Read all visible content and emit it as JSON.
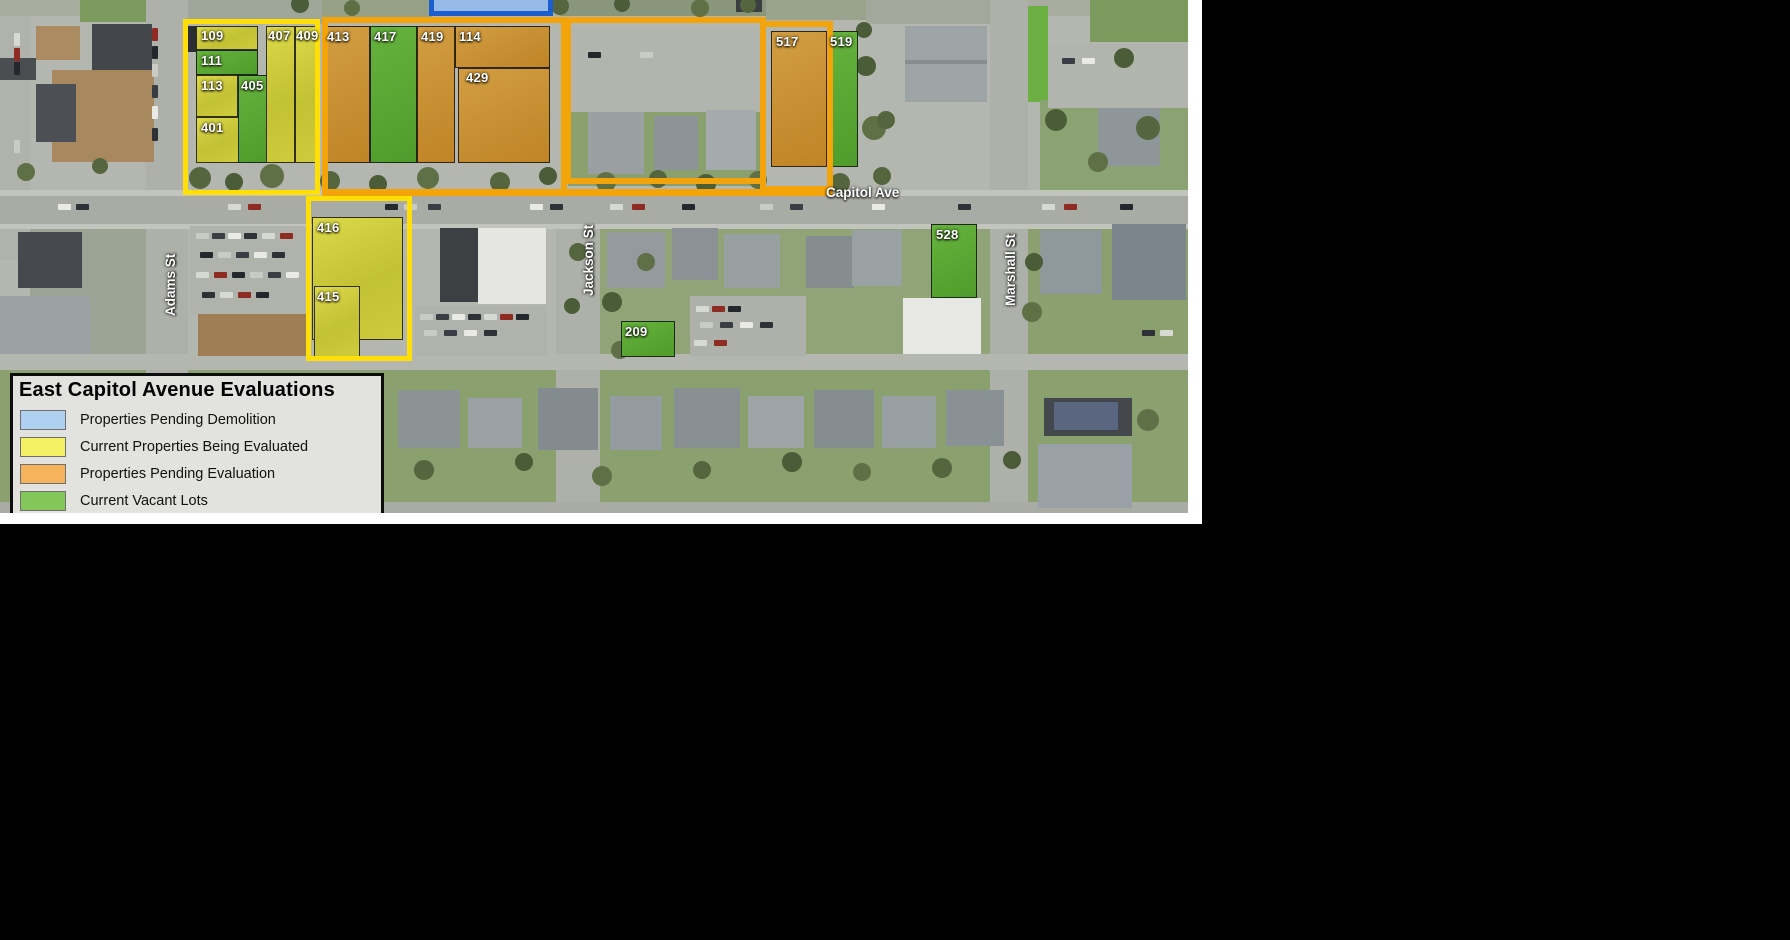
{
  "map_title": "East Capitol Avenue Evaluations",
  "legend": {
    "title": "East Capitol Avenue Evaluations",
    "items": [
      {
        "label": "Properties Pending Demolition",
        "color": "#aed1f2"
      },
      {
        "label": "Current Properties Being Evaluated",
        "color": "#f3f163"
      },
      {
        "label": "Properties Pending Evaluation",
        "color": "#f5b45c"
      },
      {
        "label": "Current Vacant Lots",
        "color": "#83c659"
      }
    ]
  },
  "streets": [
    {
      "name": "Capitol Ave",
      "x": 826,
      "y": 186,
      "vertical": false
    },
    {
      "name": "Adams St",
      "x": 164,
      "y": 316,
      "vertical": true
    },
    {
      "name": "Jackson St",
      "x": 582,
      "y": 296,
      "vertical": true
    },
    {
      "name": "Marshall St",
      "x": 1004,
      "y": 306,
      "vertical": true
    }
  ],
  "status_colors": {
    "pending_demolition_fill": "#95bae8",
    "pending_demolition_outline": "#1c5ed0",
    "being_evaluated_outline": "#ffdf06",
    "pending_evaluation_outline": "#f3a40a",
    "vacant_lot_fill": "#58a933"
  },
  "overlays": {
    "clusters": [
      {
        "name": "pending-demolition",
        "color": "#1c5ed0",
        "x": 429,
        "y": -6,
        "w": 124,
        "h": 22,
        "stroke": 5,
        "fill": "#95bae8"
      },
      {
        "name": "being-evaluated-north",
        "color": "#ffdf06",
        "x": 183,
        "y": 19,
        "w": 137,
        "h": 176,
        "stroke": 5
      },
      {
        "name": "being-evaluated-south",
        "color": "#ffdf06",
        "x": 306,
        "y": 196,
        "w": 106,
        "h": 165,
        "stroke": 5
      },
      {
        "name": "pending-evaluation-west",
        "color": "#f3a40a",
        "x": 322,
        "y": 17,
        "w": 245,
        "h": 178,
        "stroke": 6
      },
      {
        "name": "pending-evaluation-mid",
        "color": "#f3a40a",
        "x": 565,
        "y": 17,
        "w": 201,
        "h": 167,
        "stroke": 6
      },
      {
        "name": "pending-evaluation-517",
        "color": "#f3a40a",
        "x": 760,
        "y": 21,
        "w": 73,
        "h": 171,
        "stroke": 6
      }
    ],
    "bars": [
      {
        "name": "capitol-ave-line",
        "x": 322,
        "y": 189,
        "w": 511,
        "h": 7,
        "color": "#f3a40a"
      }
    ]
  },
  "parcels": [
    {
      "id": "109",
      "type": "yellow",
      "x": 196,
      "y": 26,
      "w": 62,
      "h": 24,
      "lx": 201,
      "ly": 29
    },
    {
      "id": "111",
      "type": "green",
      "x": 196,
      "y": 50,
      "w": 62,
      "h": 25,
      "lx": 201,
      "ly": 54
    },
    {
      "id": "113",
      "type": "yellow",
      "x": 196,
      "y": 75,
      "w": 42,
      "h": 42,
      "lx": 201,
      "ly": 79
    },
    {
      "id": "401",
      "type": "yellow",
      "x": 196,
      "y": 117,
      "w": 44,
      "h": 46,
      "lx": 201,
      "ly": 121
    },
    {
      "id": "405",
      "type": "green",
      "x": 238,
      "y": 75,
      "w": 30,
      "h": 88,
      "lx": 241,
      "ly": 79
    },
    {
      "id": "407",
      "type": "yellow",
      "x": 266,
      "y": 26,
      "w": 29,
      "h": 137,
      "lx": 268,
      "ly": 29
    },
    {
      "id": "409",
      "type": "yellow",
      "x": 295,
      "y": 26,
      "w": 23,
      "h": 137,
      "lx": 296,
      "ly": 29
    },
    {
      "id": "413",
      "type": "orange",
      "x": 322,
      "y": 26,
      "w": 48,
      "h": 137,
      "lx": 327,
      "ly": 30
    },
    {
      "id": "417",
      "type": "green",
      "x": 370,
      "y": 26,
      "w": 47,
      "h": 137,
      "lx": 374,
      "ly": 30
    },
    {
      "id": "419",
      "type": "orange",
      "x": 417,
      "y": 26,
      "w": 38,
      "h": 137,
      "lx": 421,
      "ly": 30
    },
    {
      "id": "114",
      "type": "orange",
      "x": 455,
      "y": 26,
      "w": 95,
      "h": 42,
      "lx": 459,
      "ly": 30
    },
    {
      "id": "429",
      "type": "orange",
      "x": 458,
      "y": 68,
      "w": 92,
      "h": 95,
      "lx": 466,
      "ly": 71
    },
    {
      "id": "517",
      "type": "orange",
      "x": 771,
      "y": 31,
      "w": 56,
      "h": 136,
      "lx": 776,
      "ly": 35
    },
    {
      "id": "519",
      "type": "green",
      "x": 827,
      "y": 31,
      "w": 31,
      "h": 136,
      "lx": 830,
      "ly": 35
    },
    {
      "id": "416",
      "type": "yellow",
      "x": 312,
      "y": 217,
      "w": 91,
      "h": 123,
      "lx": 317,
      "ly": 221
    },
    {
      "id": "415",
      "type": "yellow",
      "x": 314,
      "y": 286,
      "w": 46,
      "h": 71,
      "lx": 317,
      "ly": 290
    },
    {
      "id": "209",
      "type": "green",
      "x": 621,
      "y": 321,
      "w": 54,
      "h": 36,
      "lx": 625,
      "ly": 325
    },
    {
      "id": "528",
      "type": "green",
      "x": 931,
      "y": 224,
      "w": 46,
      "h": 74,
      "lx": 936,
      "ly": 228
    }
  ],
  "frame": {
    "color": "#ffffff",
    "right": {
      "x": 1188,
      "y": 0,
      "w": 14,
      "h": 524
    },
    "bottom": {
      "x": 0,
      "y": 513,
      "w": 1202,
      "h": 11
    }
  },
  "scenery": {
    "rects": [
      [
        0,
        0,
        1188,
        16,
        "#a8ad9f"
      ],
      [
        80,
        0,
        70,
        22,
        "#7d9a5e"
      ],
      [
        155,
        0,
        170,
        24,
        "#9fa79a"
      ],
      [
        322,
        0,
        110,
        18,
        "#96a186"
      ],
      [
        560,
        0,
        206,
        16,
        "#8a967c"
      ],
      [
        766,
        0,
        100,
        20,
        "#9aa38e"
      ],
      [
        866,
        0,
        130,
        24,
        "#a2a89c"
      ],
      [
        1090,
        0,
        98,
        42,
        "#7d9a5e"
      ],
      [
        1018,
        6,
        30,
        96,
        "#6cb044"
      ],
      [
        0,
        370,
        1188,
        143,
        "#8ba06f"
      ],
      [
        600,
        229,
        390,
        126,
        "#90a478"
      ],
      [
        1028,
        229,
        160,
        126,
        "#8ba06f"
      ],
      [
        30,
        229,
        116,
        126,
        "#9ba394"
      ],
      [
        568,
        112,
        196,
        74,
        "#8ba06f"
      ],
      [
        1040,
        100,
        148,
        100,
        "#8ba272"
      ],
      [
        0,
        16,
        30,
        244,
        "#b0b3ab"
      ],
      [
        146,
        0,
        42,
        513,
        "#aeb1a9"
      ],
      [
        990,
        0,
        38,
        513,
        "#aeb1a9"
      ],
      [
        556,
        220,
        44,
        293,
        "#aeb1a9"
      ],
      [
        0,
        196,
        1188,
        28,
        "#a9aca4"
      ],
      [
        0,
        354,
        1188,
        16,
        "#b4b6b0"
      ],
      [
        0,
        502,
        1188,
        11,
        "#a9aca4"
      ],
      [
        0,
        190,
        1188,
        6,
        "#c2c4be"
      ],
      [
        0,
        224,
        1188,
        5,
        "#c2c4be"
      ],
      [
        570,
        28,
        192,
        84,
        "#b2b5ad"
      ],
      [
        1048,
        44,
        140,
        64,
        "#b2b5ad"
      ],
      [
        190,
        226,
        118,
        88,
        "#b0b3ab"
      ],
      [
        415,
        306,
        132,
        50,
        "#b0b3ab"
      ],
      [
        690,
        296,
        116,
        60,
        "#aeb1a9"
      ],
      [
        0,
        58,
        36,
        22,
        "#4a4e50"
      ],
      [
        36,
        26,
        44,
        34,
        "#ab8c62"
      ],
      [
        92,
        24,
        60,
        46,
        "#43474b"
      ],
      [
        52,
        70,
        102,
        92,
        "#a8895f"
      ],
      [
        36,
        84,
        40,
        58,
        "#4c5054"
      ],
      [
        905,
        26,
        82,
        76,
        "#9da4a6"
      ],
      [
        905,
        60,
        82,
        4,
        "#878e90"
      ],
      [
        588,
        112,
        56,
        62,
        "#9aa0a2"
      ],
      [
        654,
        116,
        44,
        54,
        "#8d9396"
      ],
      [
        706,
        110,
        50,
        60,
        "#a5abad"
      ],
      [
        1098,
        108,
        62,
        58,
        "#8f9699"
      ],
      [
        18,
        232,
        64,
        56,
        "#464a4e"
      ],
      [
        0,
        296,
        90,
        58,
        "#9ba1a3"
      ],
      [
        198,
        314,
        110,
        42,
        "#9e7f55"
      ],
      [
        440,
        228,
        38,
        74,
        "#3c4043"
      ],
      [
        478,
        228,
        68,
        76,
        "#e5e5e1"
      ],
      [
        607,
        232,
        58,
        56,
        "#949a9d"
      ],
      [
        672,
        228,
        46,
        52,
        "#8b9194"
      ],
      [
        724,
        234,
        56,
        54,
        "#99a0a2"
      ],
      [
        806,
        236,
        48,
        52,
        "#868d8f"
      ],
      [
        852,
        230,
        50,
        56,
        "#9aa1a3"
      ],
      [
        903,
        298,
        78,
        56,
        "#e7e7e3"
      ],
      [
        1040,
        230,
        62,
        64,
        "#8f989a"
      ],
      [
        1112,
        224,
        74,
        76,
        "#7b858b"
      ],
      [
        398,
        390,
        62,
        58,
        "#8c9395"
      ],
      [
        468,
        398,
        54,
        50,
        "#9aa0a3"
      ],
      [
        538,
        388,
        60,
        62,
        "#848b8e"
      ],
      [
        610,
        396,
        52,
        54,
        "#959c9f"
      ],
      [
        674,
        388,
        66,
        60,
        "#899093"
      ],
      [
        748,
        396,
        56,
        52,
        "#9ea4a7"
      ],
      [
        814,
        390,
        60,
        58,
        "#868d90"
      ],
      [
        882,
        396,
        54,
        52,
        "#99a0a3"
      ],
      [
        946,
        390,
        58,
        56,
        "#8a9194"
      ],
      [
        1044,
        398,
        88,
        38,
        "#44484c"
      ],
      [
        1054,
        402,
        64,
        28,
        "#5a6680"
      ],
      [
        1038,
        444,
        94,
        64,
        "#99a1a7"
      ],
      [
        184,
        26,
        12,
        26,
        "#2b2e30"
      ],
      [
        736,
        0,
        26,
        12,
        "#3a3e40"
      ]
    ],
    "car_palette": [
      "#e9e9e5",
      "#2e3237",
      "#d7d9d3",
      "#8e2b22",
      "#24282c",
      "#c9cbc5",
      "#3a3e44"
    ],
    "car_rows": [
      {
        "y": 204,
        "xs": [
          58,
          76,
          228,
          248,
          385,
          404,
          428,
          530,
          550,
          610,
          632,
          682,
          760,
          790,
          872,
          958,
          1042,
          1064,
          1120
        ]
      },
      {
        "y": 233,
        "xs": [
          196,
          212,
          228,
          244,
          262,
          280
        ]
      },
      {
        "y": 252,
        "xs": [
          200,
          218,
          236,
          254,
          272
        ]
      },
      {
        "y": 272,
        "xs": [
          196,
          214,
          232,
          250,
          268,
          286
        ]
      },
      {
        "y": 292,
        "xs": [
          202,
          220,
          238,
          256
        ]
      },
      {
        "y": 314,
        "xs": [
          420,
          436,
          452,
          468,
          484,
          500,
          516
        ]
      },
      {
        "y": 330,
        "xs": [
          424,
          444,
          464,
          484
        ]
      },
      {
        "y": 306,
        "xs": [
          696,
          712,
          728
        ]
      },
      {
        "y": 322,
        "xs": [
          700,
          720,
          740,
          760
        ]
      },
      {
        "y": 340,
        "xs": [
          694,
          714
        ]
      },
      {
        "y": 52,
        "xs": [
          588,
          640
        ]
      },
      {
        "y": 58,
        "xs": [
          1062,
          1082
        ]
      },
      {
        "y": 330,
        "xs": [
          1142,
          1160
        ]
      }
    ],
    "car_cols": [
      {
        "x": 152,
        "ys": [
          28,
          46,
          64,
          85,
          106,
          128
        ]
      },
      {
        "x": 14,
        "ys": [
          33,
          48,
          62,
          140
        ]
      }
    ],
    "tree_palette": [
      "#55663f",
      "#4b5c38",
      "#5f7046"
    ],
    "trees": [
      [
        200,
        178,
        11
      ],
      [
        234,
        182,
        9
      ],
      [
        272,
        176,
        12
      ],
      [
        330,
        181,
        10
      ],
      [
        378,
        184,
        9
      ],
      [
        428,
        178,
        11
      ],
      [
        500,
        182,
        10
      ],
      [
        548,
        176,
        9
      ],
      [
        606,
        182,
        10
      ],
      [
        658,
        179,
        9
      ],
      [
        706,
        184,
        10
      ],
      [
        758,
        180,
        9
      ],
      [
        840,
        183,
        10
      ],
      [
        866,
        66,
        10
      ],
      [
        874,
        128,
        12
      ],
      [
        882,
        176,
        9
      ],
      [
        1056,
        120,
        11
      ],
      [
        1098,
        162,
        10
      ],
      [
        1148,
        128,
        12
      ],
      [
        300,
        4,
        9
      ],
      [
        352,
        8,
        8
      ],
      [
        560,
        6,
        9
      ],
      [
        622,
        4,
        8
      ],
      [
        700,
        8,
        9
      ],
      [
        748,
        5,
        8
      ],
      [
        1124,
        58,
        10
      ],
      [
        26,
        172,
        9
      ],
      [
        100,
        166,
        8
      ],
      [
        612,
        302,
        10
      ],
      [
        646,
        262,
        9
      ],
      [
        962,
        252,
        10
      ],
      [
        1034,
        262,
        9
      ],
      [
        1032,
        312,
        10
      ],
      [
        578,
        252,
        9
      ],
      [
        572,
        306,
        8
      ],
      [
        620,
        350,
        9
      ],
      [
        424,
        470,
        10
      ],
      [
        524,
        462,
        9
      ],
      [
        602,
        476,
        10
      ],
      [
        702,
        470,
        9
      ],
      [
        792,
        462,
        10
      ],
      [
        862,
        472,
        9
      ],
      [
        942,
        468,
        10
      ],
      [
        1012,
        460,
        9
      ],
      [
        1148,
        420,
        11
      ],
      [
        886,
        120,
        9
      ],
      [
        864,
        30,
        8
      ]
    ]
  }
}
